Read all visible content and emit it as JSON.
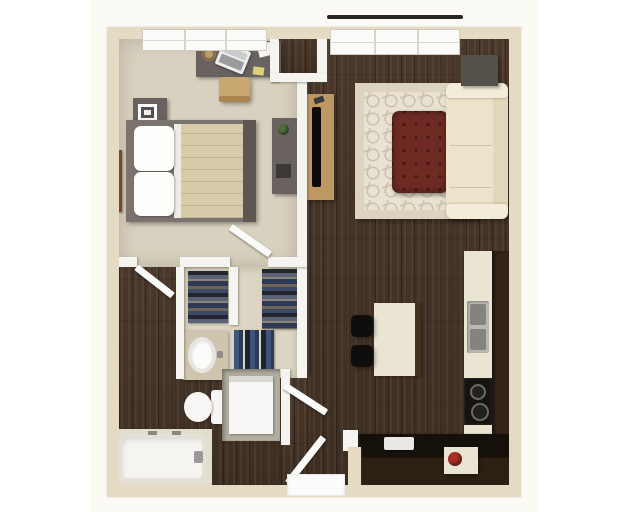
{
  "scene": {
    "kind": "3d-rendered-apartment-floor-plan",
    "view": "top-down",
    "visible_text": "none",
    "layout": "one-bedroom apartment: bedroom top-left, living room right, kitchen bottom-right, bathroom and walk-in closet bottom-left, entry at bottom center"
  },
  "rooms": [
    {
      "name": "bedroom",
      "floor": "beige carpet",
      "furniture": [
        "desk",
        "laptop",
        "coffee-mug",
        "papers",
        "desk-chair",
        "nightstand",
        "picture-frame",
        "bed",
        "pillows",
        "quilted-blanket",
        "headboard",
        "wall-art",
        "dresser",
        "plant"
      ]
    },
    {
      "name": "living-room",
      "floor": "dark wood planks",
      "furniture": [
        "window",
        "balcony-ledge",
        "corner-side-table",
        "sectional-sofa",
        "trellis-area-rug",
        "tufted-red-ottoman",
        "tv-console",
        "flat-tv",
        "wall-hanging"
      ]
    },
    {
      "name": "kitchen",
      "floor": "dark wood planks",
      "furniture": [
        "island",
        "bar-stool",
        "bar-stool",
        "wall-counter",
        "double-basin-sink",
        "black-cooktop",
        "dark-lower-counter",
        "white-countertop-appliance",
        "red-kettle",
        "dark-cabinet-run"
      ]
    },
    {
      "name": "walk-in-closet",
      "floor": "light beige",
      "furniture": [
        "hanging-clothes-left-rack",
        "hanging-clothes-right-rack",
        "hanging-jeans-lower-rack"
      ]
    },
    {
      "name": "bathroom",
      "floor": "dark wood planks",
      "furniture": [
        "vanity-with-oval-sink",
        "toilet",
        "bathtub",
        "tub-faucet"
      ]
    },
    {
      "name": "laundry-nook",
      "furniture": [
        "washer-dryer-unit"
      ]
    },
    {
      "name": "entry",
      "furniture": [
        "entry-door-open",
        "hall-door-open",
        "threshold"
      ]
    }
  ],
  "doors": [
    "bathroom-door-open",
    "closet-door-open",
    "hall-bath-door-open",
    "entry-door-open"
  ],
  "windows": [
    "bedroom-window-top",
    "living-room-window-top"
  ],
  "palette": {
    "background": "#ffffff",
    "outer-wall": "#e5dbc4",
    "inner-wall": "#f5f4f0",
    "carpet": "#d8d1bf",
    "dark-wood-floor": "#443427",
    "closet-floor": "#dcd5c3",
    "rug-field": "#e9e2d2",
    "rug-pattern": "#cbc2ac",
    "ottoman": "#6e2b23",
    "sofa": "#ece3ca",
    "gray-furniture": "#696260",
    "wood-console": "#bd9862",
    "counter-cream": "#eae4d3",
    "counter-dark": "#1c130c",
    "appliance-black": "#15120f",
    "kettle-red": "#a72f24",
    "balcony-line": "#2a2520"
  }
}
